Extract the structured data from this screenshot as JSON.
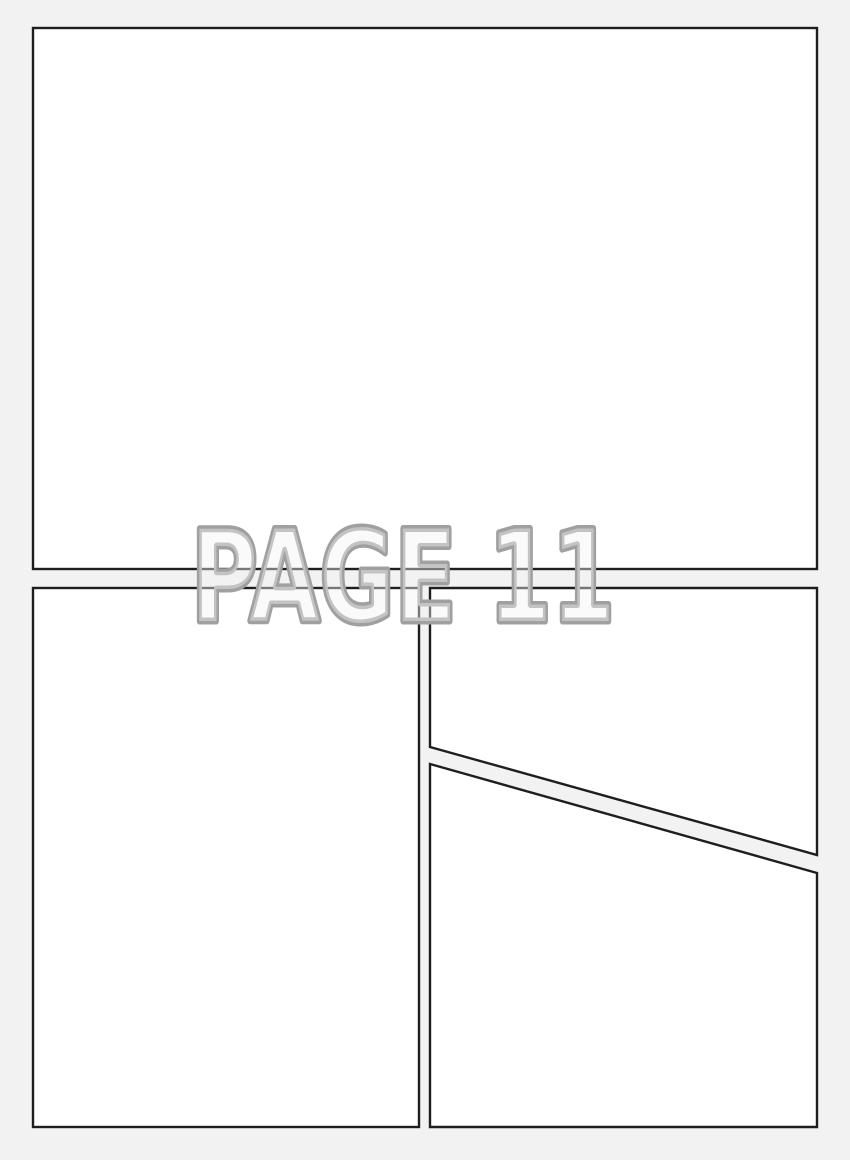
{
  "page": {
    "label": "PAGE 11",
    "panel_count": 4
  },
  "colors": {
    "background": "#f2f2f2",
    "panel_fill": "#ffffff",
    "panel_border": "#1e1e1e",
    "label_outline": "#a0a0a0",
    "label_fill": "rgba(242,242,242,0.42)"
  },
  "panels": [
    {
      "id": "panel-top"
    },
    {
      "id": "panel-bottom-left"
    },
    {
      "id": "panel-bottom-right-upper"
    },
    {
      "id": "panel-bottom-right-lower"
    }
  ]
}
